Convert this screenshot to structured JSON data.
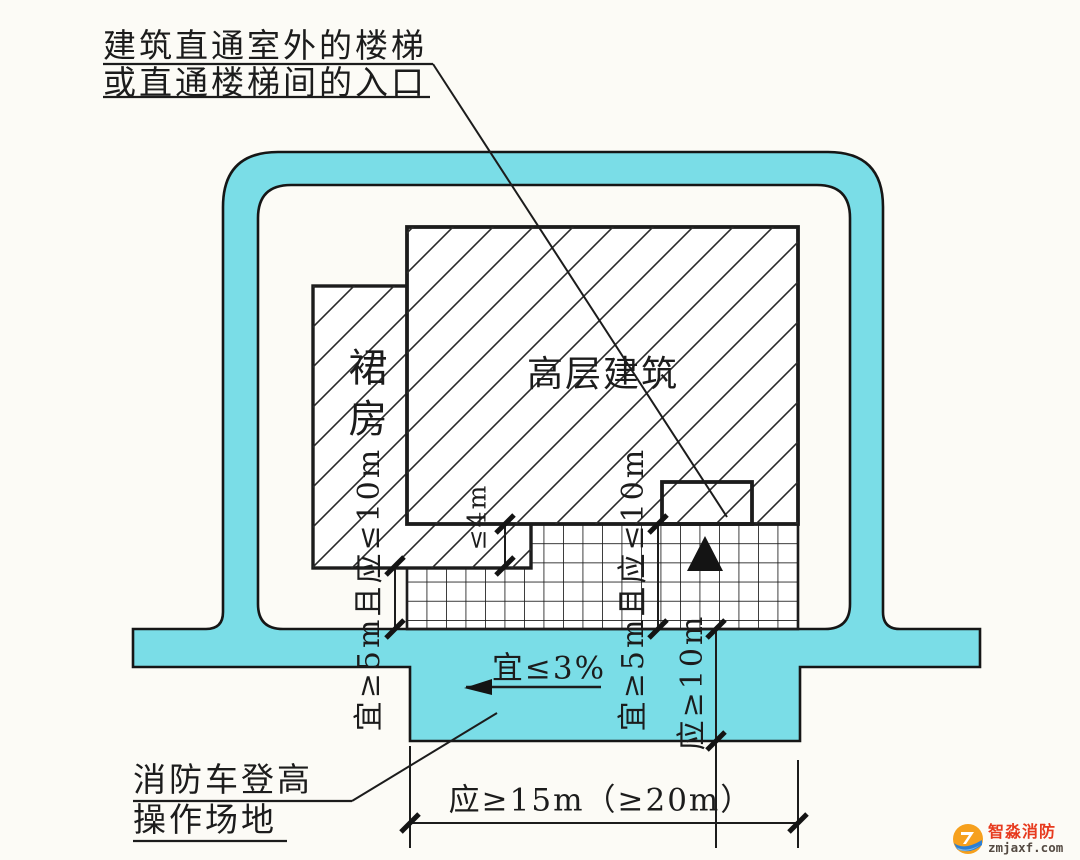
{
  "diagram": {
    "callout_top": {
      "line1": "建筑直通室外的楼梯",
      "line2": "或直通楼梯间的入口"
    },
    "highrise_label": "高层建筑",
    "podium_label": "裙房",
    "dims": {
      "left_offset": "宜≥5m且应≤10m",
      "right_offset": "宜≥5m且应≤10m",
      "podium_depth": "≤4m",
      "site_width": "应≥10m",
      "site_length": "应≥15m（≥20m）",
      "slope": "宜≤3%"
    },
    "callout_bottom": {
      "line1": "消防车登高",
      "line2": "操作场地"
    },
    "colors": {
      "road_fill": "#7adde7",
      "ink": "#1c1c1c"
    }
  },
  "watermark": {
    "brand": "智淼消防",
    "domain": "zmjaxf.com",
    "brand_color": "#e73a1e"
  }
}
